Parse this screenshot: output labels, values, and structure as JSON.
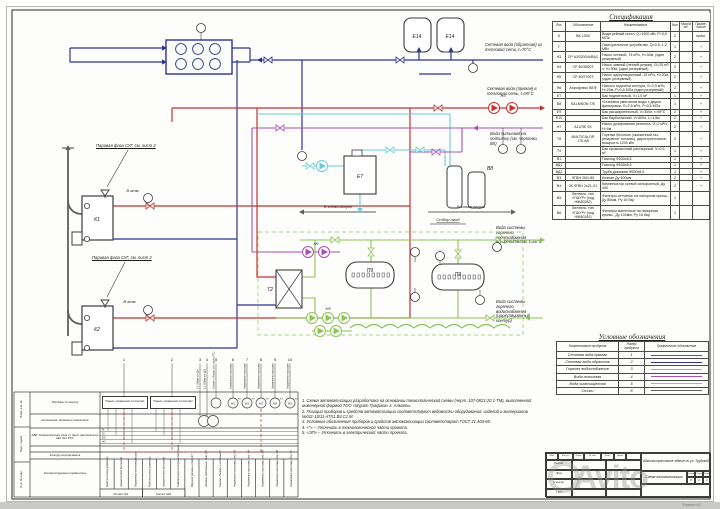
{
  "watermark": "Avito",
  "format_note": "Формат А3",
  "colors": {
    "supply": "#c4332e",
    "return": "#2e3392",
    "hws": "#8cc455",
    "potable": "#aa4fb5",
    "treated": "#67ccd6",
    "drain": "#5f5f5f",
    "frame": "#3c3c3c"
  },
  "annotations": {
    "return_line": "Сетевая вода (обратная) из тепловой сети, t=70°C",
    "supply_line": "Сетевая вода (прямая) в тепловую сеть, t=95°C",
    "potable_line": "Вода питьевая на подпитку (см. чертежи ВК)",
    "hws_supply": "Вода системы горячего водоснабжения потребителям, t=60°C",
    "hws_return": "Вода системы горячего водоснабжения (циркуляционный контур)",
    "lpg1": "Паровая фаза СУГ, см. лист 2",
    "lpg2": "Паровая фаза СУГ, см. лист 2",
    "drain1": "В канализацию",
    "drain2": "В канализацию",
    "sample": "Отбор проб",
    "atm1": "В атм.",
    "atm2": "В атм."
  },
  "equipment": {
    "boiler1": "К1",
    "boiler2": "К2",
    "tank_e14a": "Е14",
    "tank_e14b": "Е14",
    "tank_e7": "Е7",
    "hx": "Т2",
    "vessel1": "П9",
    "vessel2": "П9",
    "softener": "В8",
    "pump_n3": "Н3",
    "pump_n5": "Н5",
    "pump_n6": "Н6"
  },
  "spec_table": {
    "title": "Спецификация",
    "columns": [
      "Поз.",
      "Обозначение",
      "Наименование",
      "Кол.",
      "Масса ед.",
      "Приме-чание"
    ],
    "rows": [
      [
        "К",
        "ВК-1000",
        "Водогрейный котел, Q=1000 кВт, Р=0,6 МПа",
        "2",
        "",
        "прим."
      ],
      [
        "Г",
        "",
        "Газогорелочное устройство, Q=0,5–1,2 МВт",
        "1",
        "",
        "+"
      ],
      [
        "Н3",
        "CP 40/3200/А/ВАС",
        "Насос сетевой, 75 м³/ч, Н=30м, (один резервный)",
        "2",
        "",
        "+"
      ],
      [
        "Н4",
        "CP 40/3500Т",
        "Насос зимний (летний режим), G=25 м³/ч, Н=30м, (один резервный)",
        "2",
        "",
        "+"
      ],
      [
        "Н5",
        "CP 40/2700Т",
        "Насос циркуляционный, 10 м³/ч, Н=20м, (один резервный)",
        "2",
        "",
        "+"
      ],
      [
        "Н6",
        "Аэрофлекс ВЕФ",
        "Насосы подпитки контура, G=2,5 м³/ч, Н=20м, Р=0,6 МПа (один резервный)",
        "2",
        "",
        "+"
      ],
      [
        "Е7",
        "",
        "Бак подпиточный, V=1,0 м³",
        "1",
        "",
        "+"
      ],
      [
        "В8",
        "SALMSON Т/Е",
        "Установка умягчения воды с двумя фильтрами, G=2,5 м³/ч, Р=0,6 МПа",
        "1",
        "",
        "+"
      ],
      [
        "Е9",
        "",
        "Бак расширительный, V=300л, t=95°С",
        "2",
        "",
        "+"
      ],
      [
        "Е10",
        "",
        "Бак барботажный, V=400л, L=1,5м",
        "2",
        "",
        "+"
      ],
      [
        "Н7",
        "А12/ЛЕ 9Х",
        "Насос дозирования реагента, G=2 м³/ч, Н=9м",
        "2",
        "",
        "+"
      ],
      [
        "Т8",
        "MULTICALOR 170.АВ",
        "Горелки блочные (сжиженный газ, резервное топливо), двухступенчатые, мощность 1200 кВт",
        "2",
        "",
        "+"
      ],
      [
        "Т9",
        "",
        "Бак промывочный растворный, V=0,5 м³",
        "1",
        "",
        "+"
      ],
      [
        "В1",
        "",
        "Газоход Ф530х8,5",
        "1",
        "",
        "+"
      ],
      [
        "ВД1",
        "",
        "Газоход Ф530х8,5",
        "1",
        "",
        "+"
      ],
      [
        "ВД2",
        "",
        "Труба дымовая Ф530х8,5",
        "1",
        "",
        "+"
      ],
      [
        "В3",
        "ЛГВН 2М1-80",
        "Клапан Ду 400мм",
        "2",
        "",
        "+"
      ],
      [
        "В4",
        "2К ЛГВН 2х21-Л1",
        "Компенсатор осевой сильфонный, Ду 400",
        "2",
        "",
        "+"
      ],
      [
        "В5",
        "Вентиль, тип «ГШУР» (под НЖ80282)",
        "Фильтры сетчатые на напорном кронш., Ду 80мм, Ру 16 бар",
        "1",
        "",
        ""
      ],
      [
        "В6",
        "Вентиль, тип «ГШУР» (под НЖ80282)",
        "Фильтры магнитные на напорном кронш., Ду 100мм, Ру 16 бар",
        "1",
        "",
        ""
      ]
    ]
  },
  "legend": {
    "title": "Условные обозначения",
    "columns": [
      "Наименование продукта",
      "Номер продукта",
      "Графическое обозначение"
    ],
    "rows": [
      {
        "name": "Сетевая вода прямая",
        "num": "1",
        "color": "#c4332e"
      },
      {
        "name": "Сетевая вода обратная",
        "num": "2",
        "color": "#2e3392"
      },
      {
        "name": "Горячее водоснабжение",
        "num": "3",
        "color": "#8cc455"
      },
      {
        "name": "Вода питьевая",
        "num": "4",
        "color": "#aa4fb5"
      },
      {
        "name": "Вода химочищенная",
        "num": "5",
        "color": "#67ccd6"
      },
      {
        "name": "Стоки",
        "num": "8",
        "color": "#5f5f5f"
      }
    ]
  },
  "notes": [
    "1. Схема автоматизации разработана на основании технологической схемы (черт. 107-0823-20.1-ТМ), выполненной инженерной фирмой ТОО «Мурат Графика» г. Алматы.",
    "2. Позиции приборов и средств автоматизации соответствуют ведомости оборудования, изделий и материалов №011-10/11-АТХ1.В4.С1.М.",
    "3. Условные обозначения приборов и средств автоматизации соответствуют ГОСТ 21.404-85.",
    "4. «*» – Уточнить в технологической части проекта.",
    "5. «ЭП» – Уточнить в электрической части проекта."
  ],
  "automation": {
    "row_labels": [
      "Приборы по месту",
      "Котельная. Комната оператора",
      "АБК. Операторская (пом.1). Щит автоматики ЩА №1 РСУ",
      "Контур регулирования",
      "Контролируемые параметры"
    ],
    "panel1": "Панель управления котлом №1",
    "panel2": "Панель управления котлом №2",
    "signal_numbers": [
      "1",
      "2",
      "3",
      "4",
      "5",
      "6",
      "7",
      "8",
      "9",
      "10"
    ],
    "signal_texts": [
      "1,1 ОВмм от ДН",
      "1,1 ОВмм от ДН",
      "Сигнал «Пожар» (от щита ПС)",
      "Управление насосами",
      "Управление насосами",
      "Управление насосами",
      "Управление насосами",
      "Управление насосами"
    ],
    "io_labels": [
      "AI",
      "DI",
      "DO",
      "AO"
    ],
    "columns": [
      "Работа котла (горение)",
      "Авария котла (останов)",
      "Управление котлом (розжиг)",
      "Работа котла (горение)",
      "Авария котла (останов)",
      "Температура контура отопления",
      "Верхний уровень в баке Е7",
      "Уровень предельный, пом. ХВ",
      "Сигнал «Пожар» в котельной",
      "Управление насосами, поз. Н3",
      "Управление насосами, поз. Н4",
      "Управление насосами, поз. Н5",
      "Управление насосами, поз. Н6",
      "Управление насосами, поз. Н7"
    ],
    "groups": [
      "Котел №1",
      "Котел №2"
    ],
    "bubble": "HS",
    "bubble_sup": "ЭП",
    "margin_labels": [
      "Взам. инв. №",
      "Подп. и дата",
      "Инв. № подл."
    ]
  },
  "title_block": {
    "header_cells": [
      "Изм.",
      "Кол.уч.",
      "Лист",
      "№ док.",
      "Подп.",
      "Дата"
    ],
    "roles": [
      "Разраб.",
      "Пров.",
      "Н.контр.",
      "ГИП"
    ],
    "project": "Административное здание по ул. Трудовой",
    "sheet_title": "Схема автоматизации",
    "stage_label": "Стадия",
    "sheet_label": "Лист",
    "sheets_label": "Листов",
    "stage": "Р",
    "sheet": "1",
    "sheets": "2"
  }
}
